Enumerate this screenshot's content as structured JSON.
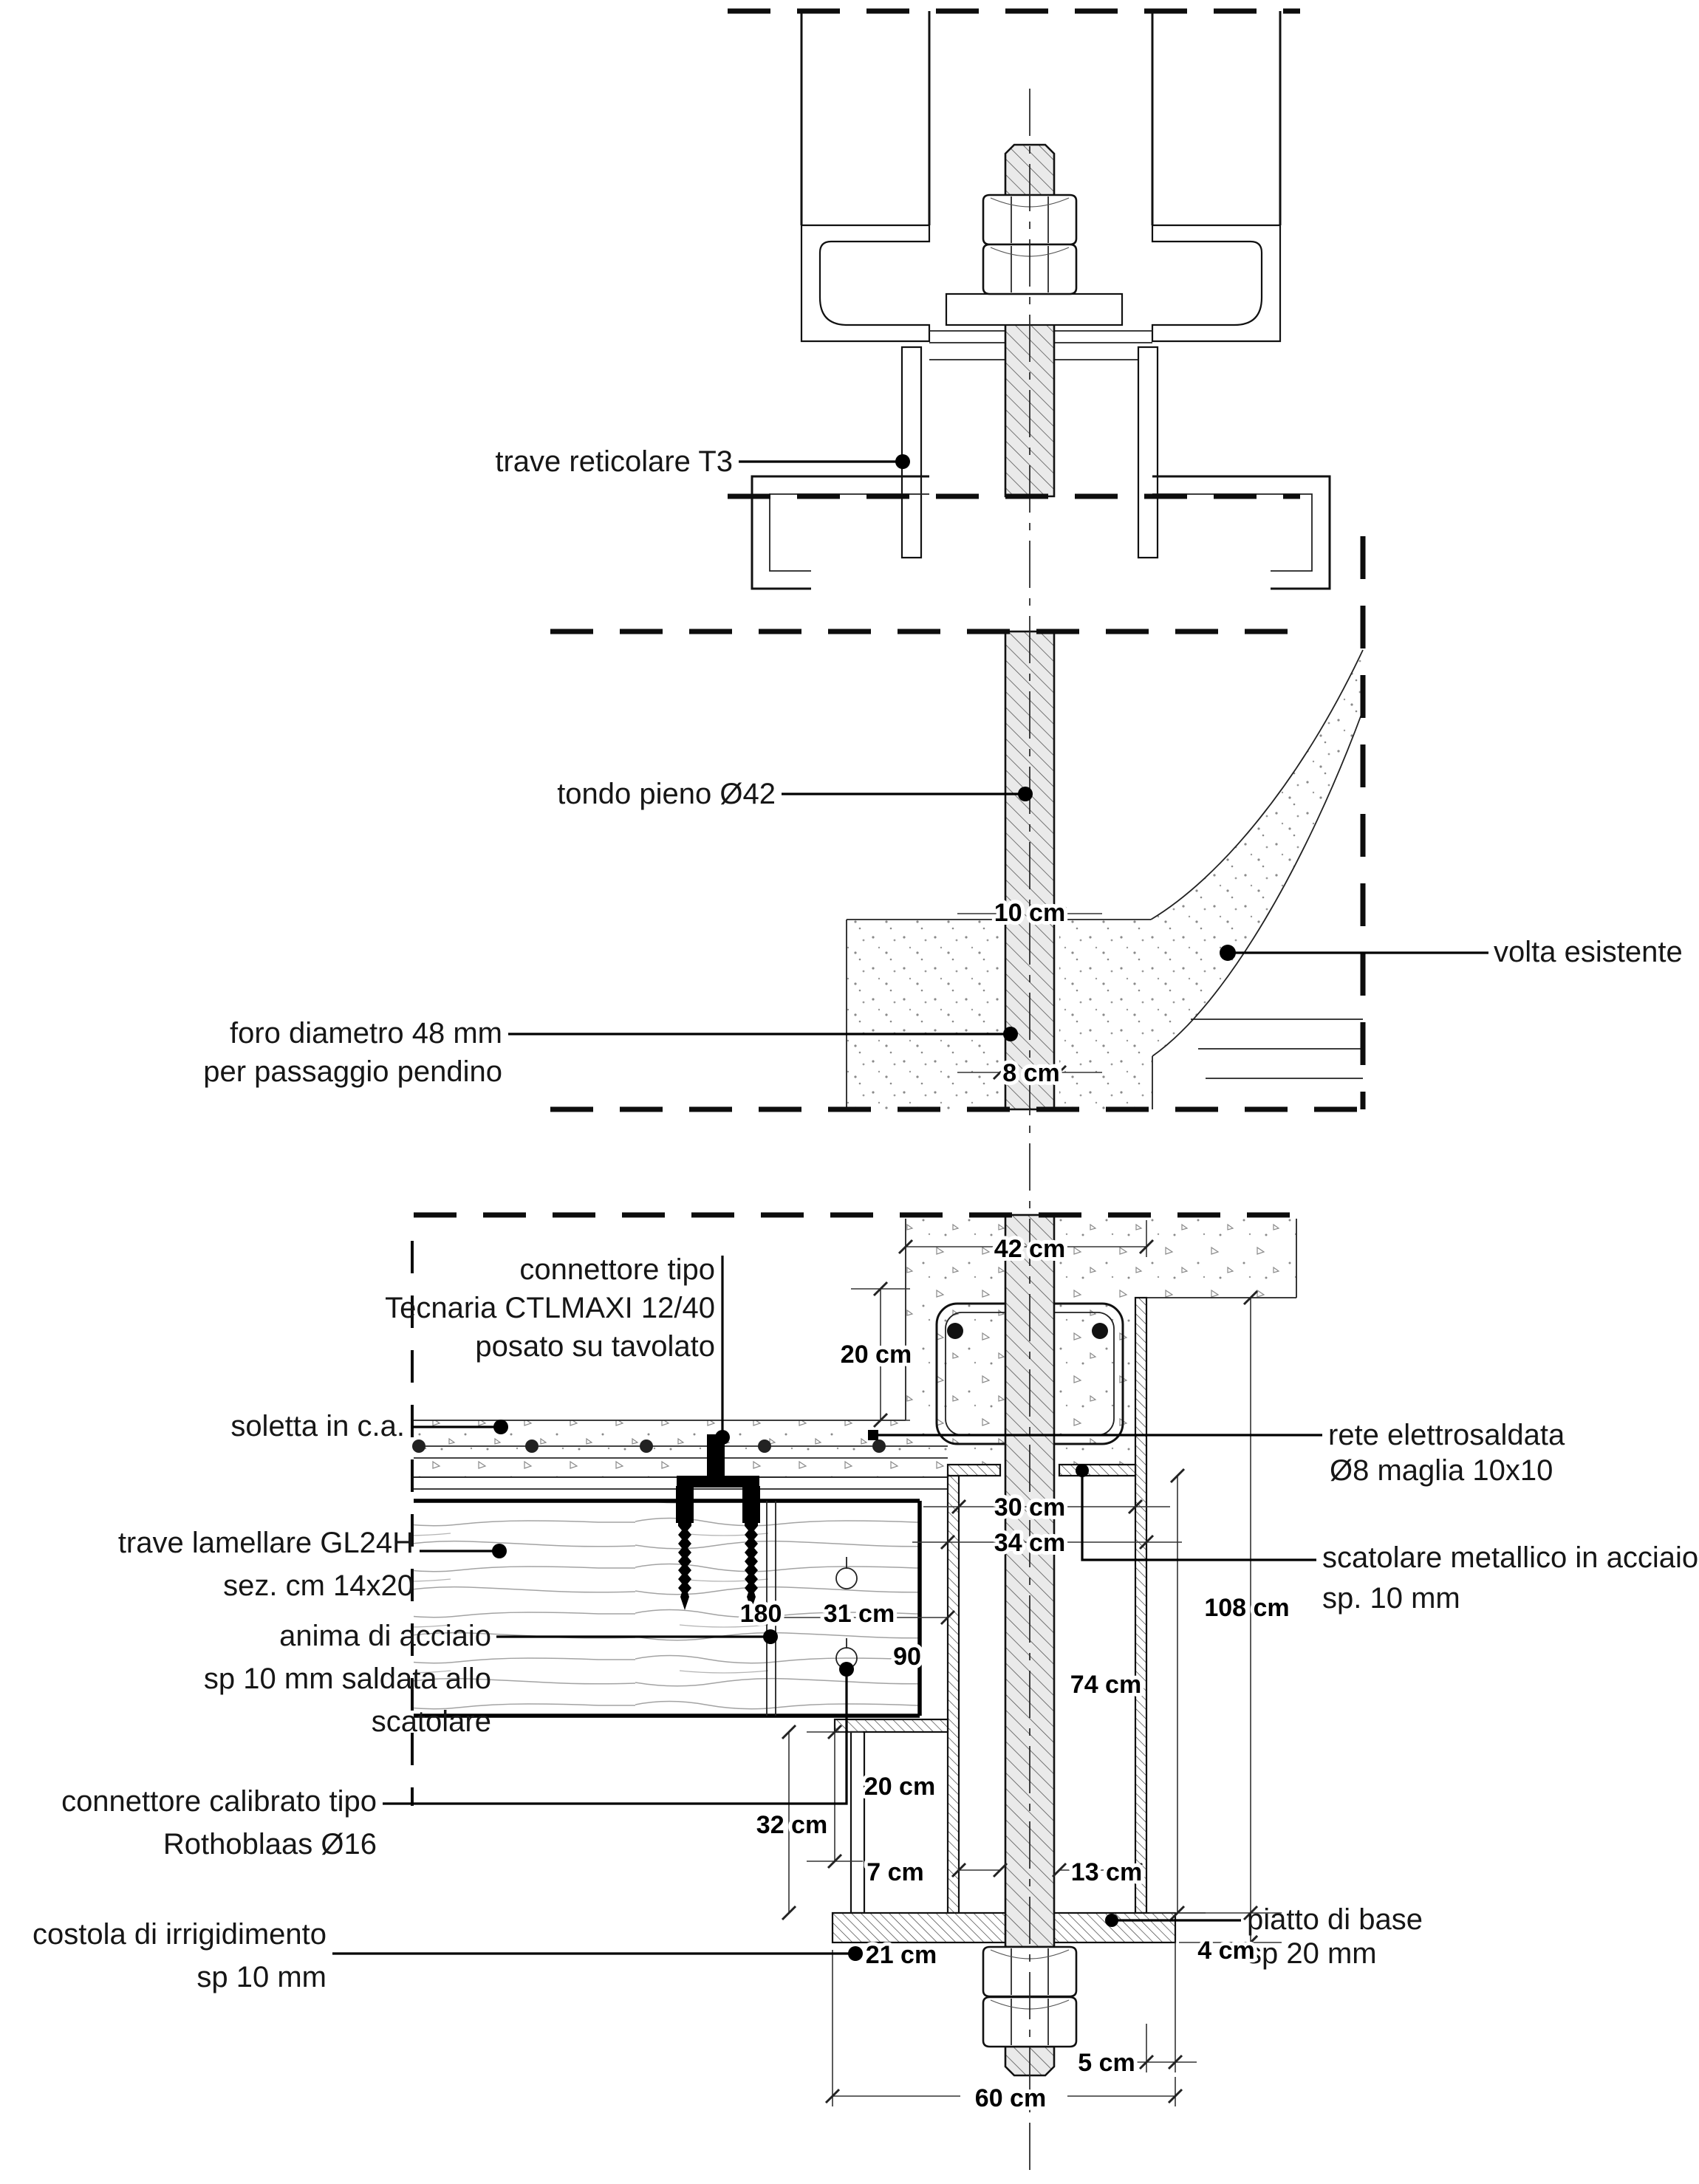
{
  "document": {
    "type": "structural detail drawing",
    "language": "it",
    "colors": {
      "paper": "#ffffff",
      "ink": "#111111",
      "rod_fill": "#eaeaea",
      "grain": "#a0a0a0",
      "stipple": "#8a8a8a"
    }
  },
  "callouts": {
    "trave_reticolare": "trave reticolare T3",
    "tondo_pieno": "tondo pieno Ø42",
    "volta_esistente": "volta esistente",
    "foro": [
      "foro diametro 48 mm",
      "per passaggio pendino"
    ],
    "connettore_tecnaria": [
      "connettore tipo",
      "Tecnaria CTLMAXI 12/40",
      "posato su tavolato"
    ],
    "soletta": "soletta in c.a.",
    "trave_lamellare": [
      "trave lamellare GL24H",
      "sez. cm 14x20"
    ],
    "anima": [
      "anima di acciaio",
      "sp 10 mm saldata allo",
      "scatolare"
    ],
    "connettore_calibrato": [
      "connettore calibrato tipo",
      "Rothoblaas Ø16"
    ],
    "costola": [
      "costola di irrigidimento",
      "sp 10 mm"
    ],
    "rete": [
      "rete elettrosaldata",
      "Ø8  maglia 10x10"
    ],
    "scatolare": [
      "scatolare metallico in acciaio",
      "sp. 10 mm"
    ],
    "piatto": [
      "piatto di base",
      "sp 20 mm"
    ]
  },
  "dimensions": {
    "rod_width": "10  cm",
    "rod_cover": "8  cm",
    "cordolo_width": "42  cm",
    "cordolo_height": "20  cm",
    "box_inner": "30  cm",
    "box_outer": "34  cm",
    "conn_180": "180",
    "beam_end": "31  cm",
    "conn_90": "90",
    "box_height": "74  cm",
    "total_height": "108  cm",
    "gap_20": "20  cm",
    "gap_32": "32  cm",
    "gap_7": "7  cm",
    "gap_13": "13  cm",
    "plate_left": "21  cm",
    "plate_thk": "4  cm",
    "plate_lip": "5  cm",
    "plate_width": "60  cm"
  }
}
